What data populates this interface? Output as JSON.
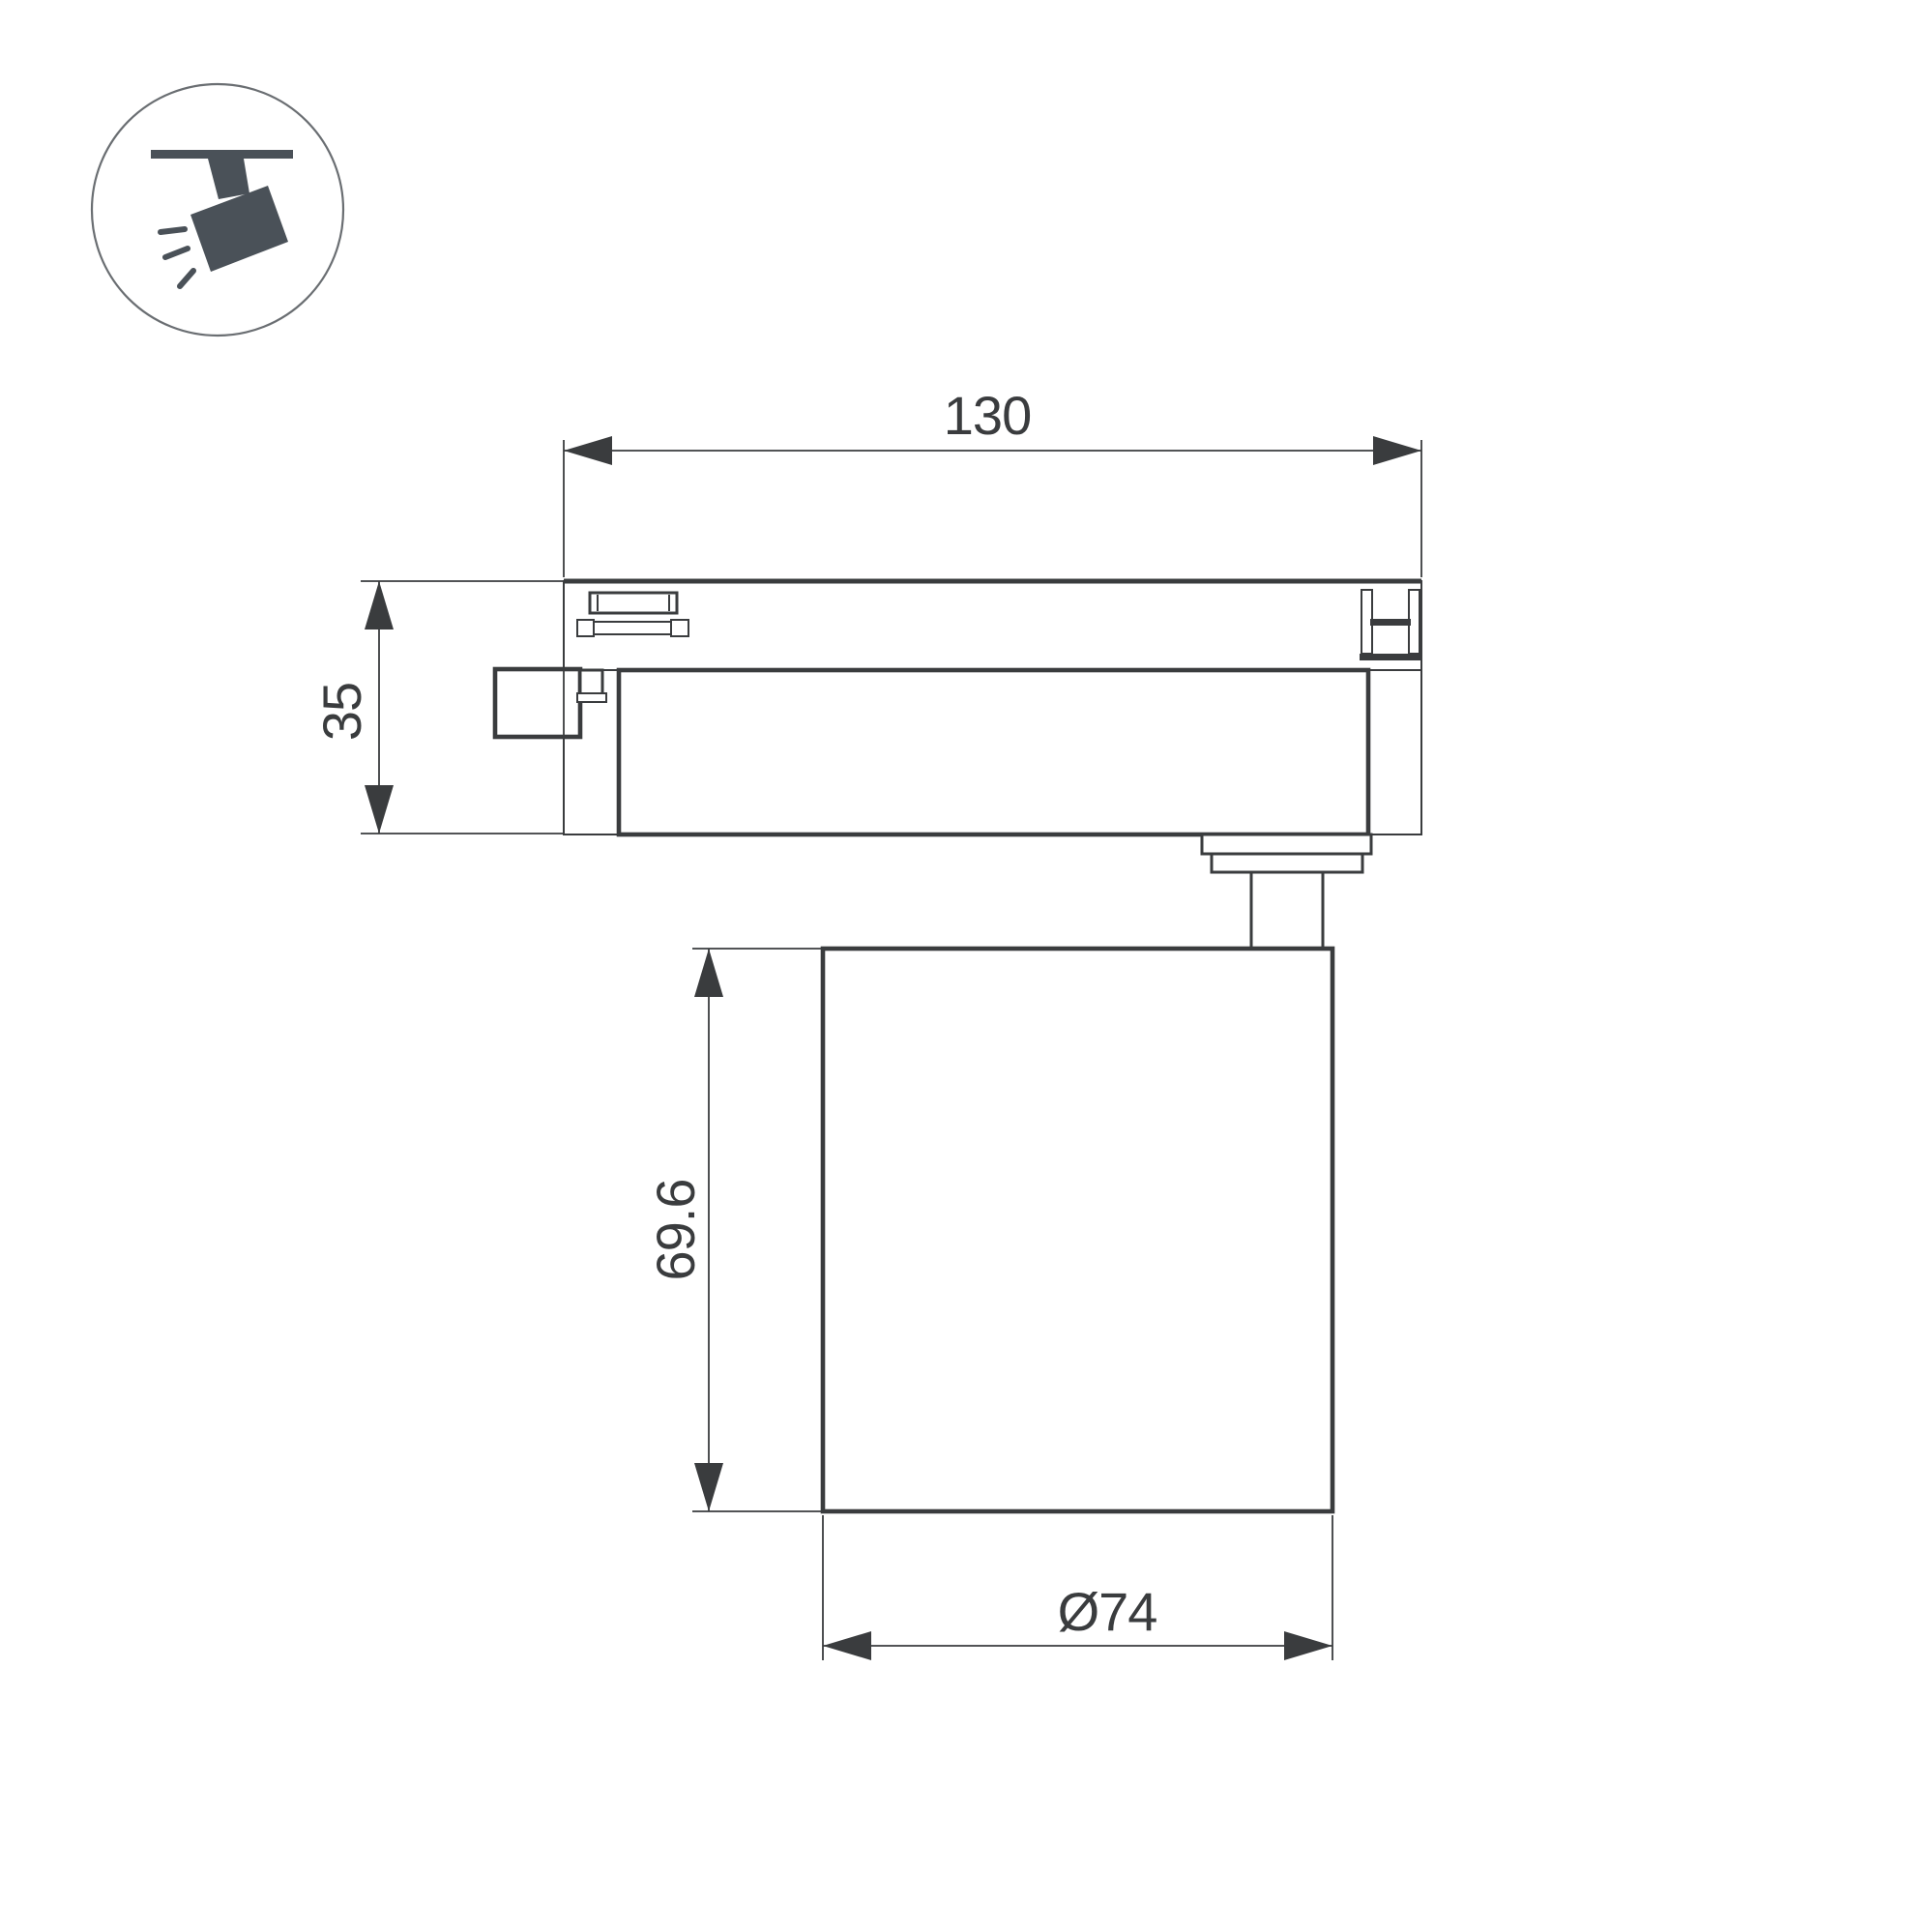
{
  "drawing": {
    "type": "technical-dimension-drawing",
    "subject": "track-mounted spotlight, side view",
    "dimensions": {
      "width_top": "130",
      "height_left": "35",
      "body_height": "69.6",
      "diameter_bottom": "Ø74"
    },
    "icon": {
      "name": "ceiling-track-spotlight-icon"
    },
    "colors": {
      "line": "#3a3c3e",
      "icon_fill": "#4a5158",
      "circle_stroke": "#6a6e72",
      "background": "#ffffff"
    }
  }
}
